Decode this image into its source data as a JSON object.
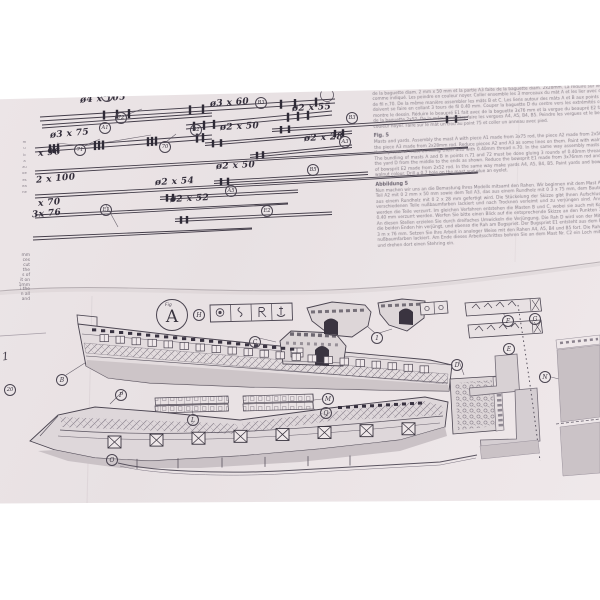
{
  "sheet_top": {
    "measurements": {
      "m1": "ø4 x 105",
      "m2": "ø3 x 60",
      "m3": "ø2 x 55",
      "m4": "ø3 x 75",
      "m5": "ø2 x 50",
      "m6": "ø2 x 28",
      "m7": "x 96",
      "m8": "2 x 100",
      "m9": "ø2 x 50",
      "m10": "x 70",
      "m11": "ø2 x 54",
      "m12": "3x 76",
      "m13": "ø2 x 52"
    },
    "circles": {
      "c1": "B5",
      "c2": "72",
      "c3": "B3",
      "c4": "B3",
      "c5": "A1",
      "c6": "71",
      "c7": "70",
      "c8": "B2",
      "c9": "A3",
      "c10": "B5",
      "c11": "A5",
      "c12": "E1",
      "c13": "E2",
      "c14": "20"
    },
    "handwritten_note": "1",
    "left_margin_fragments": [
      "mm",
      "ces",
      "cut",
      "the",
      "s of",
      "it on",
      "1mm",
      "i the",
      "n all",
      "and"
    ],
    "left_margin_tiny": [
      "m",
      "u",
      "b",
      "a",
      "zu",
      "oe",
      "es",
      "ea",
      "ne"
    ],
    "text_block": {
      "para_fr": "Mâts et vergues. Assembler le mât A avec la partie A1 faite avec la baguette diam. 3 x 75 mm, la partie A2 faite de la baguette diam. 2 mm x 50 mm et la partie A3 faite de la baguette diam. 2x28mm. La réduire sur les parties comme indiqué. Les peindre en couleur noyer. Coller ensemble les 3 morceaux du mât A et les lier avec des tours de fil n.70. De la même manière assembler les mâts B et C. Les liens autour des mâts A et B aux points 71 et 72 doivent se faire en collant 3 tours de fil 0.40 mm. Couper la baguette D du centre vers les extrémités comme le montre le dessin. Réduire le beaupré E1 fait avec de la baguette 3x76 mm et la vergue du beaupré E2 faite avec de la baguette 2x52. De la même manière faire les vergues A4, A5, B4, B5. Peindre les vergues et le beaupré en couleur noyer. Faire sur le mât un trou au point 75 et coller un anneau avec pied.",
      "fig_heading": "Fig. 5",
      "para_en": "Masts and yards. Assembly the mast A with piece A1 made from 3x75 rod, the piece A2 made from 2x50 rod and the piece A3 made from 2x28mm rod. Reduce pieces A2 and A3 as some lines on them. Paint with walnut colour the 3 pieces of mast bundling them also with 0.40mm thread n.70. In the same way assembly masts B and C. The bundling of masts A and B in points n.71 and 72 must be done gluing 3 rounds of 0.40mm thread. Reduce the yard D from the middle to the ends as shown. Reduce the bowsprit E1 made from 3x76mm rod and the yard of bowsprit E2 made from 2x52 rod. In the same way make yards A4, A5, B4, B5. Paint yards and bowsprit with walnut colour. Drill a 0.7 hole on the mast and glue an eyelet.",
      "abb_heading": "Abbildung 5",
      "para_de": "Nun machen wir uns an die Bemastung Ihres Modells mitsamt den Rahen. Wir beginnen mit dem Mast A, mit dem Teil A2 mit 0 2 mm x 50 mm sowie dem Teil A3, das aus einem Rundholz mit 0 3 x 75 mm, dem Bauteil A2, das aus einem Rundholz mit 0 2 x 28 mm gefertigt wird. Die Stückelung der Skizze gibt Ihnen Aufschluss, wie die verschiedenen Teile nußbaumfarben lackiert und nach Trocknen verleimt und zu verjüngen sind. Anschließend werden die Teile verzurrt. Im gleichen Verfahren entstehen die Masten B und C, wobei sie auch mit Kordel mit 0 0.40 mm verzurrt werden. Werfen Sie bitte einen Blick auf die entsprechende Skizze an den Punkten 71 und 72. An diesen Stellen erzielen Sie durch dreifaches Umwickeln die Verjüngung. Die Rah D wird von der Mitte aus auf die beiden Enden hin verjüngt, und ebenso die Rah am Bugspriet. Der Bugspriet E1 entsteht aus dem Rundholz 0 3 m x 76 mm. Setzen Sie Ihre Arbeit in analoger Weise mit den Rahen A4, A5, B4 und B5 fort. Die Rahen werden nußbaumfarben lackiert. Am Ende dieses Arbeitsschrittes bohren Sie an dem Mast Nr. C2 ein Loch mit 0 0.7 mm und drehen dort einen Stehring ein."
    }
  },
  "sheet_bottom": {
    "fig_small": "Fig",
    "fig_big": "A",
    "circles": {
      "h": "H",
      "c": "C",
      "b": "B",
      "p": "P",
      "one": "1",
      "d": "D",
      "e": "E",
      "f": "F",
      "g": "G",
      "n": "N",
      "m": "M",
      "q": "Q",
      "l": "L",
      "o": "O"
    }
  },
  "colors": {
    "paper": "#eae3e5",
    "ink": "#46404c",
    "dark_fill": "#3a3440",
    "panel_gray": "#c9c1c4"
  }
}
